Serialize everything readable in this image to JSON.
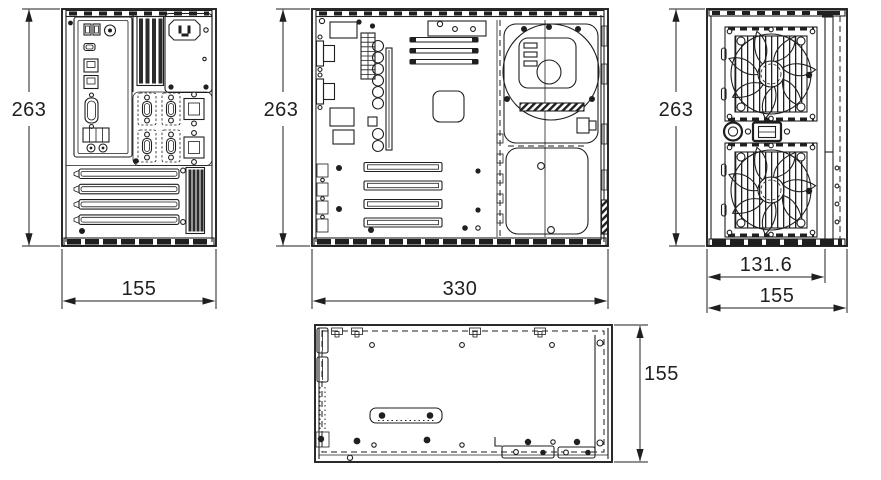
{
  "drawing": {
    "background": "#ffffff",
    "line_color": "#1f1f1f",
    "views": {
      "rear": {
        "dims": {
          "height": "263",
          "width": "155"
        }
      },
      "side": {
        "dims": {
          "height": "263",
          "width": "330"
        }
      },
      "front": {
        "dims": {
          "height": "263",
          "panel_width": "131.6",
          "width": "155"
        }
      },
      "top": {
        "dims": {
          "depth": "155"
        }
      }
    }
  }
}
